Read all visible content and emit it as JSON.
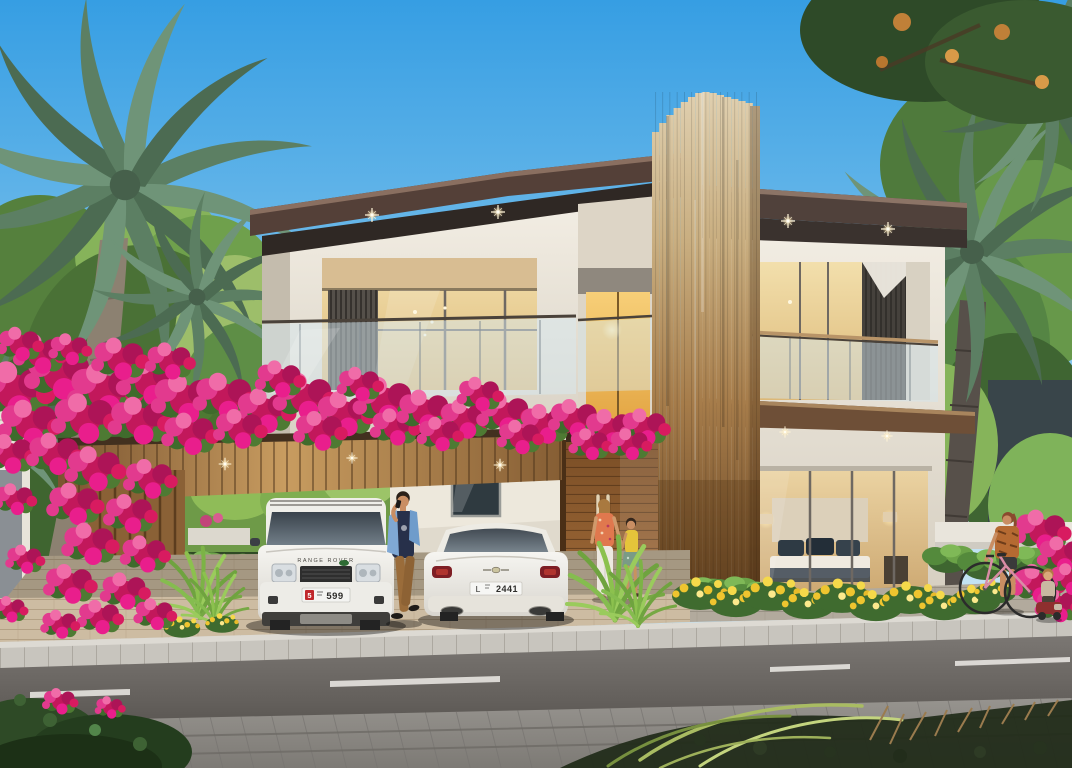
{
  "scene": {
    "description": "Photorealistic rendering of a modern two-storey villa with a bougainvillea-covered pergola carport, two white cars, and people by the street",
    "people_count": 5,
    "vehicle_count": 2
  },
  "vehicles": {
    "range_rover": {
      "hood_text": "RANGE ROVER",
      "plate": {
        "badge": "5",
        "number": "599"
      }
    },
    "bentley": {
      "plate": {
        "prefix": "L",
        "number": "2441"
      }
    }
  },
  "palette": {
    "sky_top": "#369EE3",
    "sky_horizon": "#C2E2F3",
    "wall_cream": "#EFEAE0",
    "roof_brown": "#54403A",
    "wood_slats": "#B08A58",
    "bougainvillea_pink": "#D81B7A",
    "foliage_green": "#5E8E46",
    "road_asphalt": "#6E6A66",
    "paver_beige": "#CDBCA2"
  }
}
